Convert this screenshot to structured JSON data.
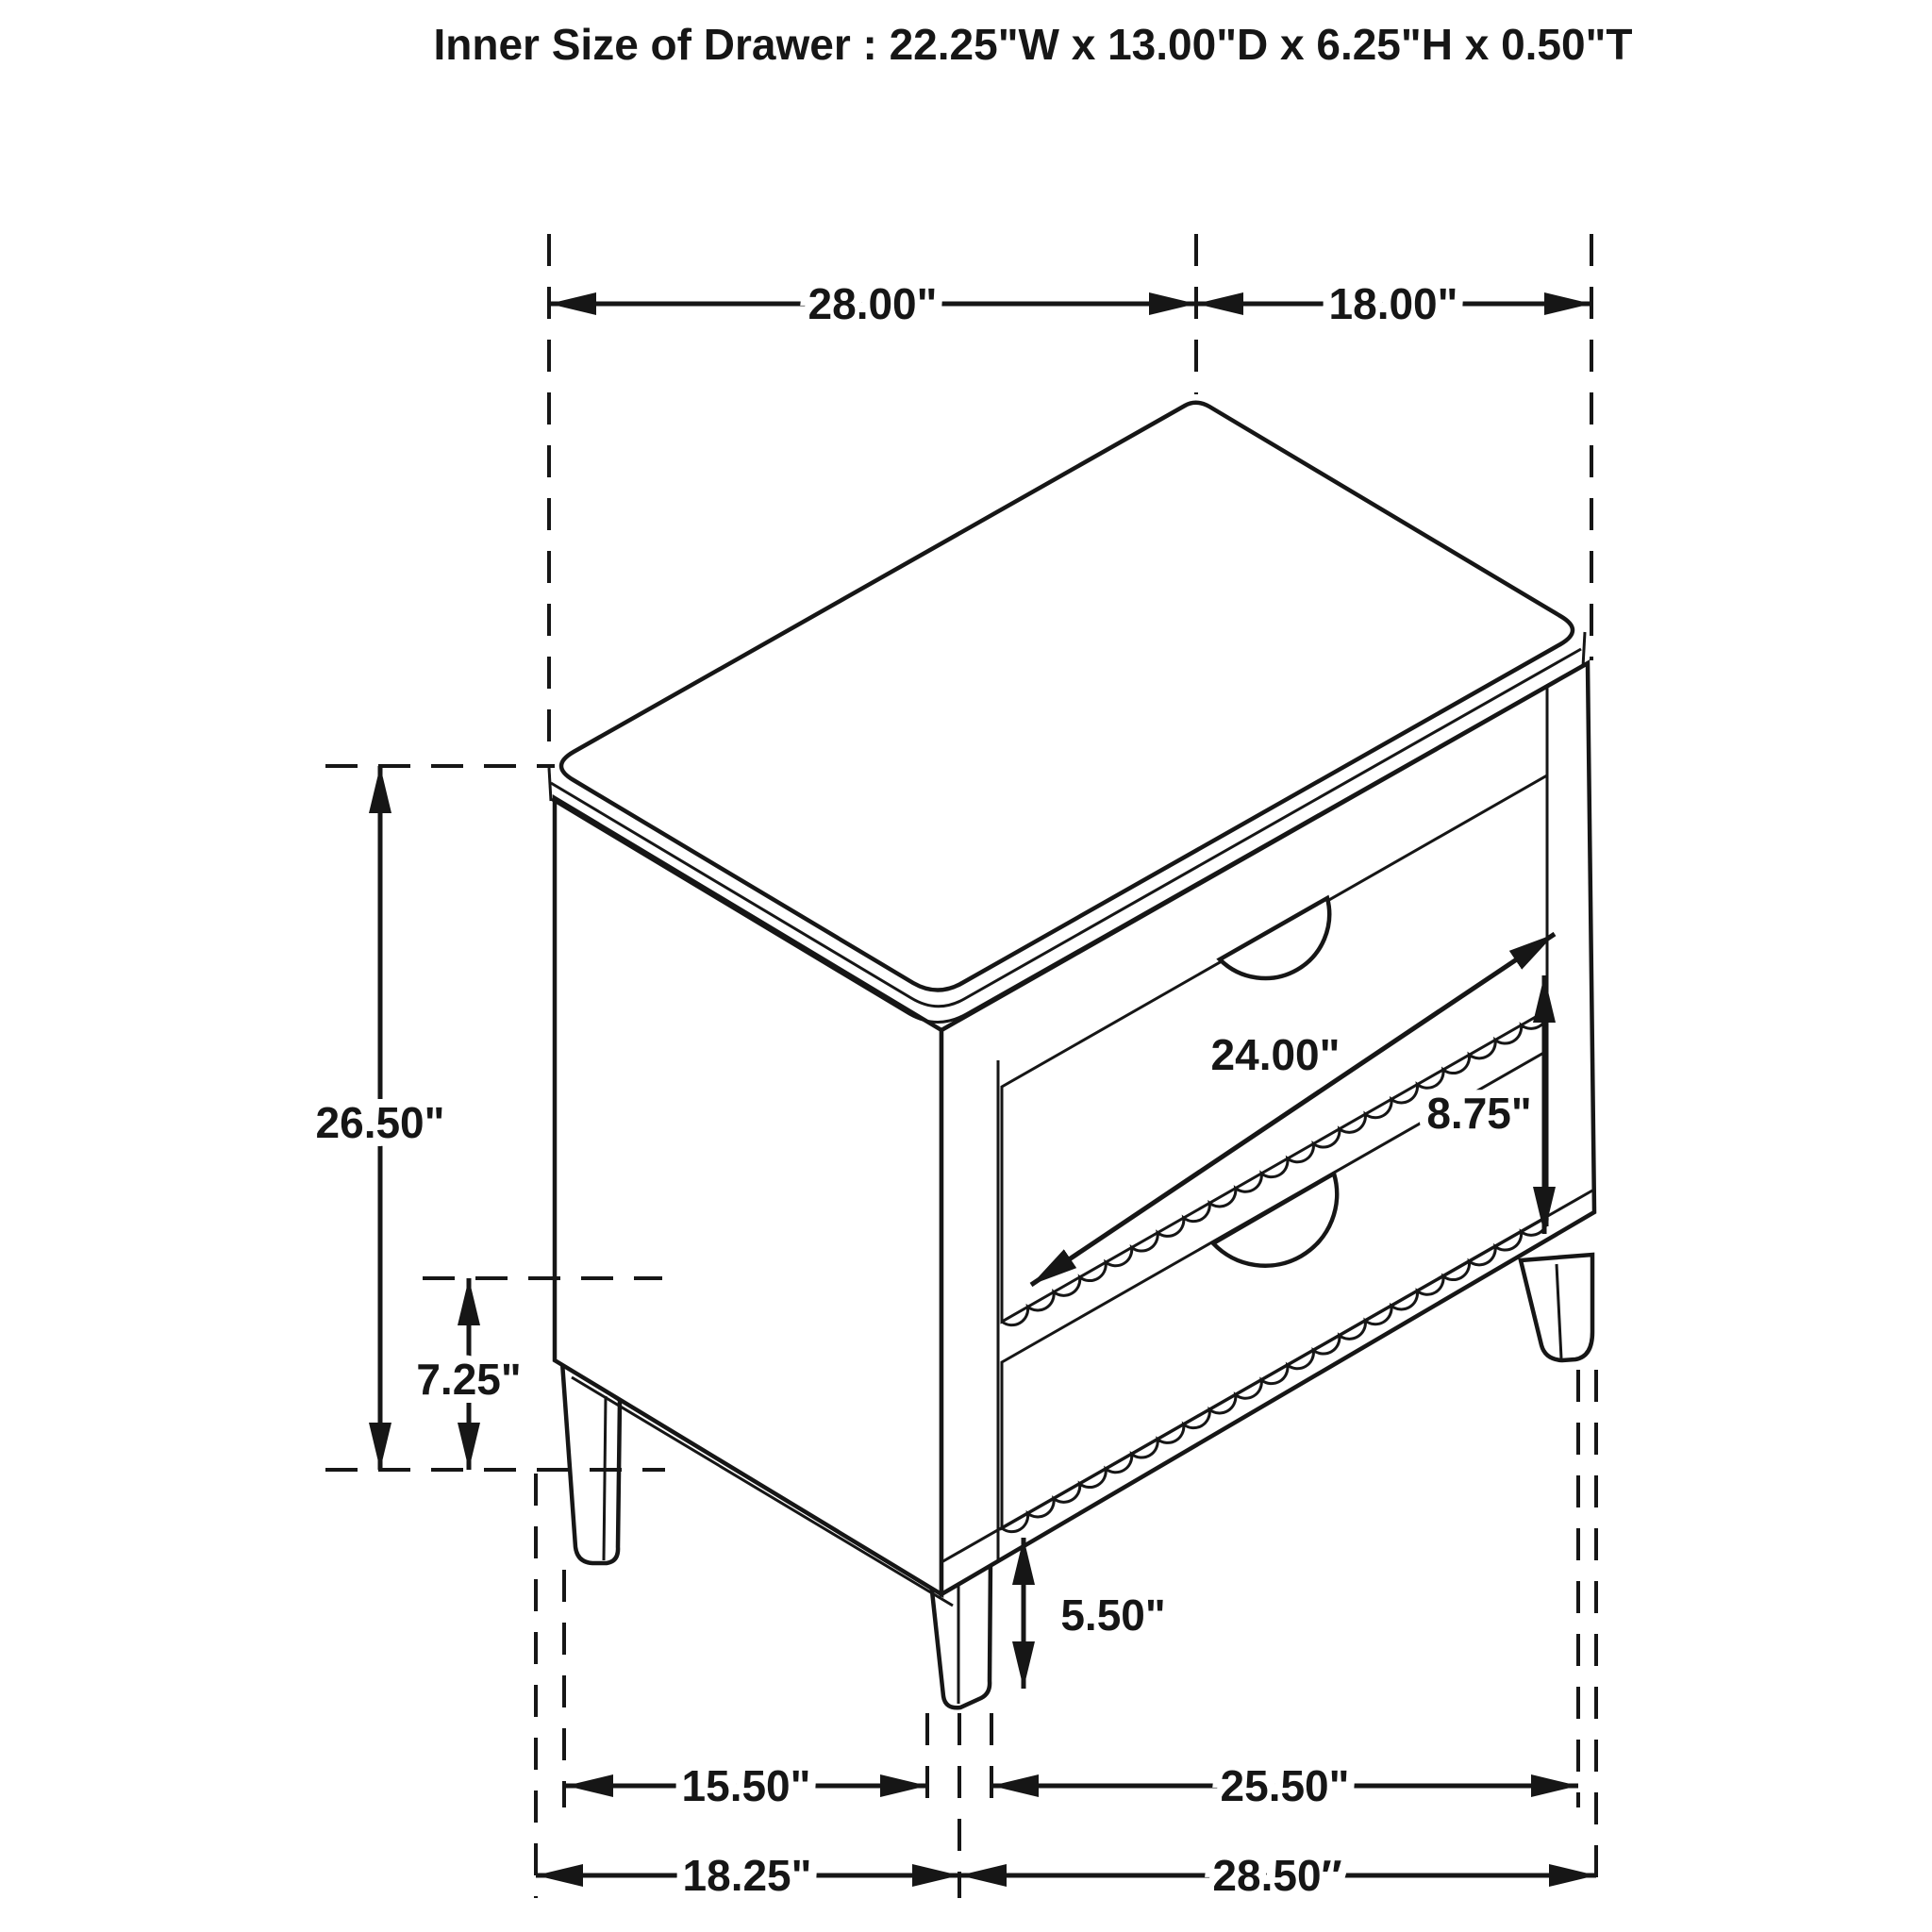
{
  "title": "Inner Size of Drawer : 22.25\"W x 13.00\"D x 6.25\"H x 0.50\"T",
  "diagram": {
    "subject": "Two-drawer nightstand isometric line drawing with dimension callouts",
    "line_color": "#161616",
    "background_color": "#ffffff",
    "dimensions": {
      "top_width": "28.00\"",
      "top_depth": "18.00\"",
      "overall_height": "26.50\"",
      "underbody_clearance": "7.25\"",
      "drawer_face_width": "24.00\"",
      "drawer_face_height": "8.75\"",
      "leg_height": "5.50\"",
      "front_leg_spacing": "15.50\"",
      "side_leg_spacing": "25.50\"",
      "front_base_width": "18.25\"",
      "side_base_depth": "28.50″"
    }
  }
}
